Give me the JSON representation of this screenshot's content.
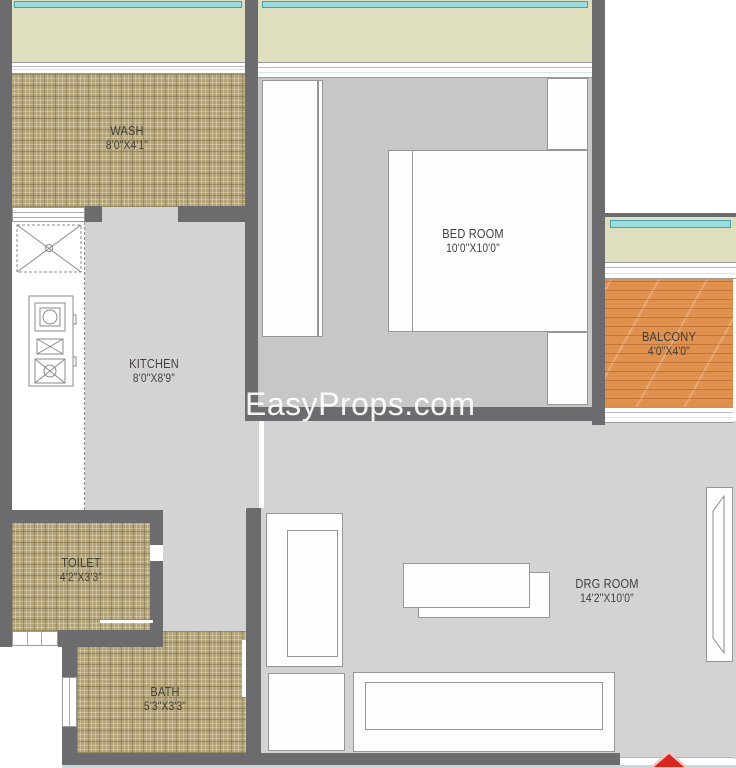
{
  "watermark": {
    "text": "EasyProps.com"
  },
  "rooms": {
    "wash": {
      "name": "WASH",
      "dims": "8'0\"X4'1\""
    },
    "kitchen": {
      "name": "KITCHEN",
      "dims": "8'0\"X8'9\""
    },
    "bedroom": {
      "name": "BED ROOM",
      "dims": "10'0\"X10'0\""
    },
    "balcony": {
      "name": "BALCONY",
      "dims": "4'0\"X4'0\""
    },
    "toilet": {
      "name": "TOILET",
      "dims": "4'2\"X3'3\""
    },
    "bath": {
      "name": "BATH",
      "dims": "5'3\"X3'3\""
    },
    "drg": {
      "name": "DRG ROOM",
      "dims": "14'2\"X10'0\""
    }
  },
  "colors": {
    "wall": "#6c6c6e",
    "floor": "#d3d3d3",
    "floor2": "#c7c7c7",
    "tile": "#b3a379",
    "wood": "#e0914e",
    "band": "#dfdfc0",
    "glass": "#9adde0",
    "arrow": "#d7271f",
    "watermark": "#ffffff"
  }
}
